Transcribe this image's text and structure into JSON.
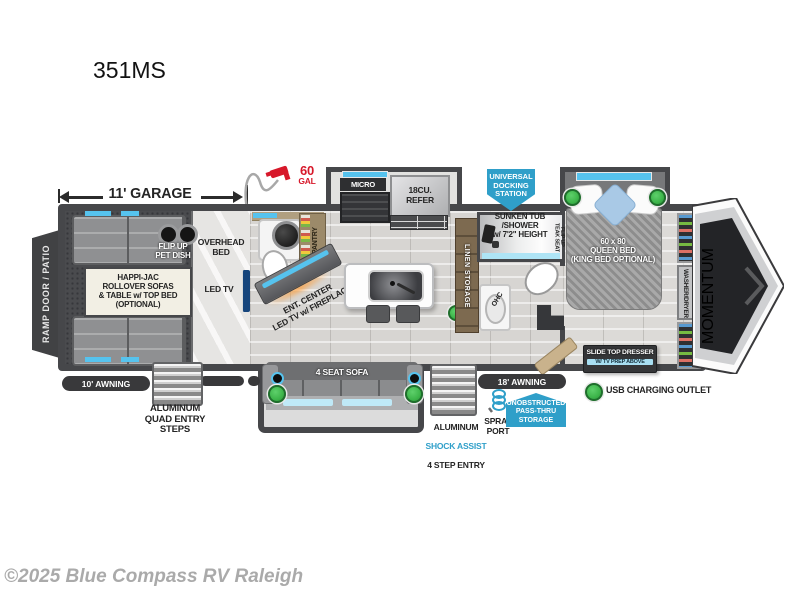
{
  "title": "351MS",
  "watermark": "©2025 Blue Compass RV Raleigh",
  "dims": {
    "garage": "11' GARAGE",
    "awning_left": "10' AWNING",
    "awning_right": "18' AWNING"
  },
  "fuel": {
    "amount": "60",
    "unit": "GAL"
  },
  "badges": {
    "docking": "UNIVERSAL\nDOCKING\nSTATION",
    "pass_thru": "UNOBSTRUCTED\nPASS-THRU\nSTORAGE"
  },
  "legend": {
    "usb": "USB CHARGING OUTLET"
  },
  "exterior": {
    "ramp": "RAMP DOOR / PATIO",
    "quad_steps": "ALUMINUM\nQUAD ENTRY\nSTEPS",
    "shock_line1": "ALUMINUM",
    "shock_line2": "SHOCK ASSIST",
    "shock_line3": "4 STEP ENTRY",
    "spray": "SPRAY\nPORT",
    "brand": "MOMENTUM"
  },
  "garage": {
    "sofas": "HAPPI-JAC\nROLLOVER SOFAS\n& TABLE w/ TOP BED\n(OPTIONAL)",
    "pet_dish": "FLIP UP\nPET DISH",
    "overhead_bed": "OVERHEAD\nBED",
    "led_tv": "LED TV"
  },
  "kitchen": {
    "micro": "MICRO",
    "refer": "18CU.\nREFER",
    "pantry": "PANTRY",
    "ent_center": "ENT. CENTER\nLED TV w/ FIREPLACE",
    "sofa": "4 SEAT SOFA",
    "linen": "LINEN STORAGE"
  },
  "bath": {
    "tub": "SUNKEN TUB /SHOWER\nw/ 7'2\" HEIGHT",
    "teak": "FLIP UP\nTEAK SEAT",
    "ohc": "OHC"
  },
  "bedroom": {
    "bed": "60 x 80\nQUEEN BED\n(KING BED OPTIONAL)",
    "dresser": "SLIDE TOP DRESSER",
    "dresser_sub": "W/ TV PREP ABOVE",
    "washer": "WASHER/DRYER\nPREP"
  },
  "colors": {
    "accent_blue": "#56c3ee",
    "badge_blue": "#2f9fc9",
    "marker_green": "#3db54a",
    "alert_red": "#d7182a"
  }
}
